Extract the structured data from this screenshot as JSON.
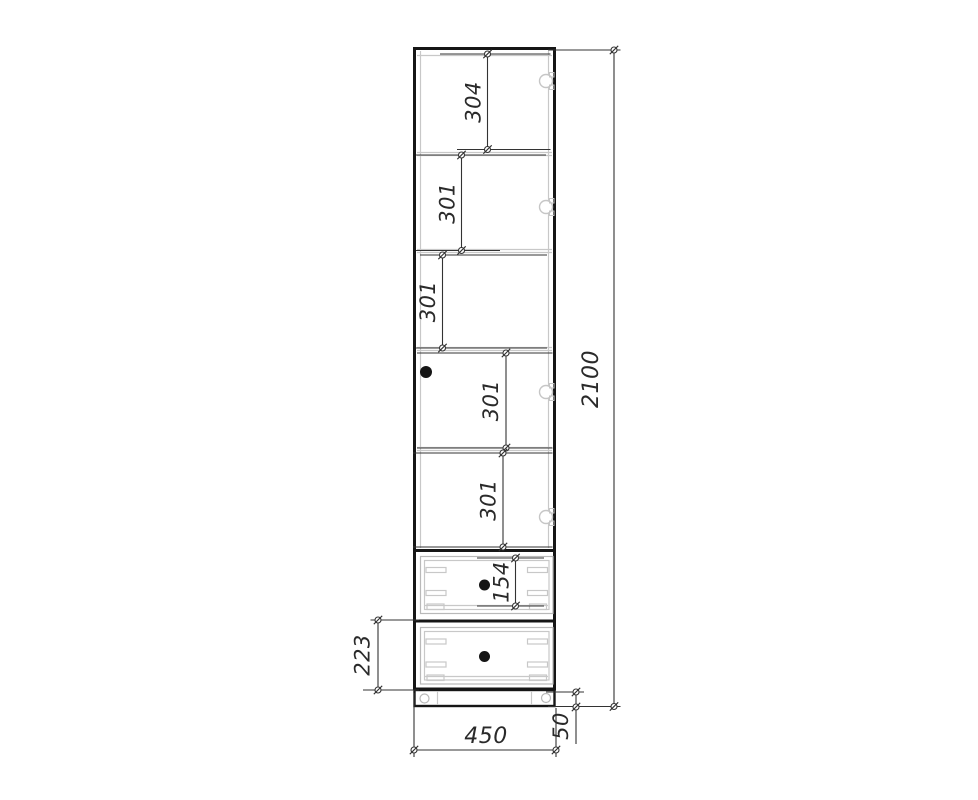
{
  "drawing": {
    "kind": "furniture-front-elevation",
    "subject": "tall cabinet with shelved door section, two drawers and plinth",
    "colors": {
      "outline": "#161616",
      "dimension_line": "#333333",
      "detail_line": "#c8c8c8",
      "hardware": "#151515",
      "background": "#ffffff"
    }
  },
  "dimensions": {
    "sections": [
      {
        "name": "top-section-height",
        "value": "304"
      },
      {
        "name": "section-2-height",
        "value": "301"
      },
      {
        "name": "section-3-height",
        "value": "301"
      },
      {
        "name": "section-4-height",
        "value": "301"
      },
      {
        "name": "section-5-height",
        "value": "301"
      }
    ],
    "top_drawer_front_height": "154",
    "bottom_drawer_height": "223",
    "overall_height": "2100",
    "overall_width": "450",
    "plinth_height": "50"
  },
  "icons": {
    "hinge": "hinge-cup-icon",
    "door_knob": "knob-icon",
    "drawer_knob": "knob-icon",
    "foot": "foot-icon",
    "dimension_endpoint": "dimension-endpoint-marker"
  }
}
